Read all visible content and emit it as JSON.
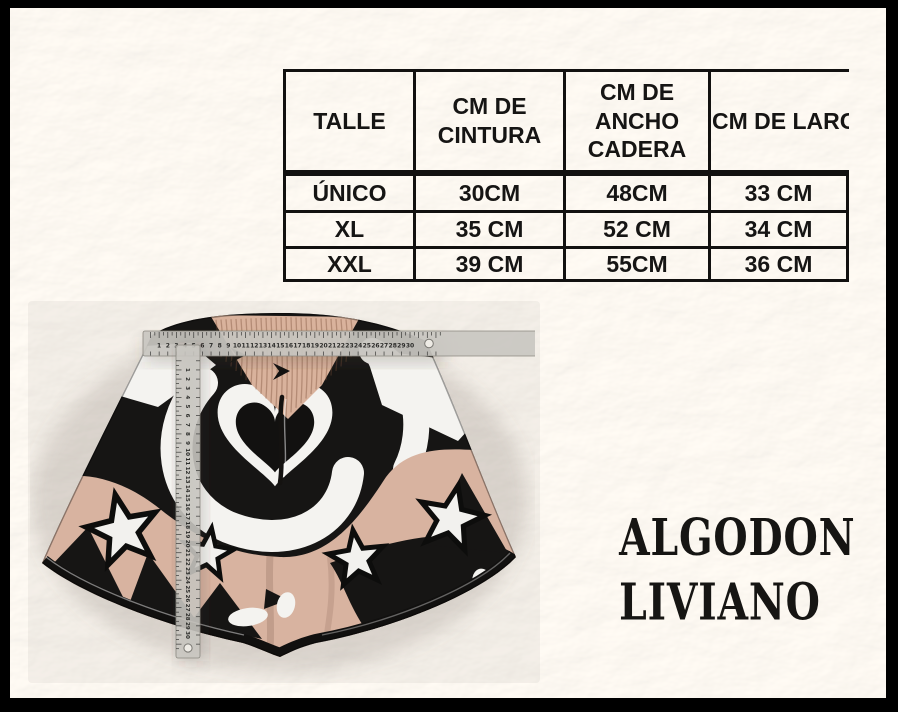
{
  "frame": {
    "border_color": "#000000",
    "fur_background": "#f0ede7"
  },
  "size_table": {
    "columns": {
      "talle": "TALLE",
      "cintura": "CM DE CINTURA",
      "cadera": "CM DE ANCHO CADERA",
      "largo": "CM DE LARGO"
    },
    "rows": [
      {
        "talle": "ÚNICO",
        "cintura": "30CM",
        "cadera": "48CM",
        "largo": "33 CM"
      },
      {
        "talle": "XL",
        "cintura": "35 CM",
        "cadera": "52 CM",
        "largo": "34 CM"
      },
      {
        "talle": "XXL",
        "cintura": "39 CM",
        "cadera": "55CM",
        "largo": "36 CM"
      }
    ]
  },
  "material_label": {
    "line1": "ALGODON",
    "line2": "LIVIANO"
  },
  "product_photo": {
    "subject": "printed shorts with stars and heart pattern",
    "pattern_colors": {
      "tan": "#d8b3a0",
      "black": "#161514",
      "white": "#f4f3f0",
      "ruler": "#c9c7c1"
    },
    "horizontal_ruler": {
      "numbers_start": 1,
      "numbers_end": 30
    },
    "vertical_ruler": {
      "numbers_start": 1,
      "numbers_end": 30
    }
  }
}
